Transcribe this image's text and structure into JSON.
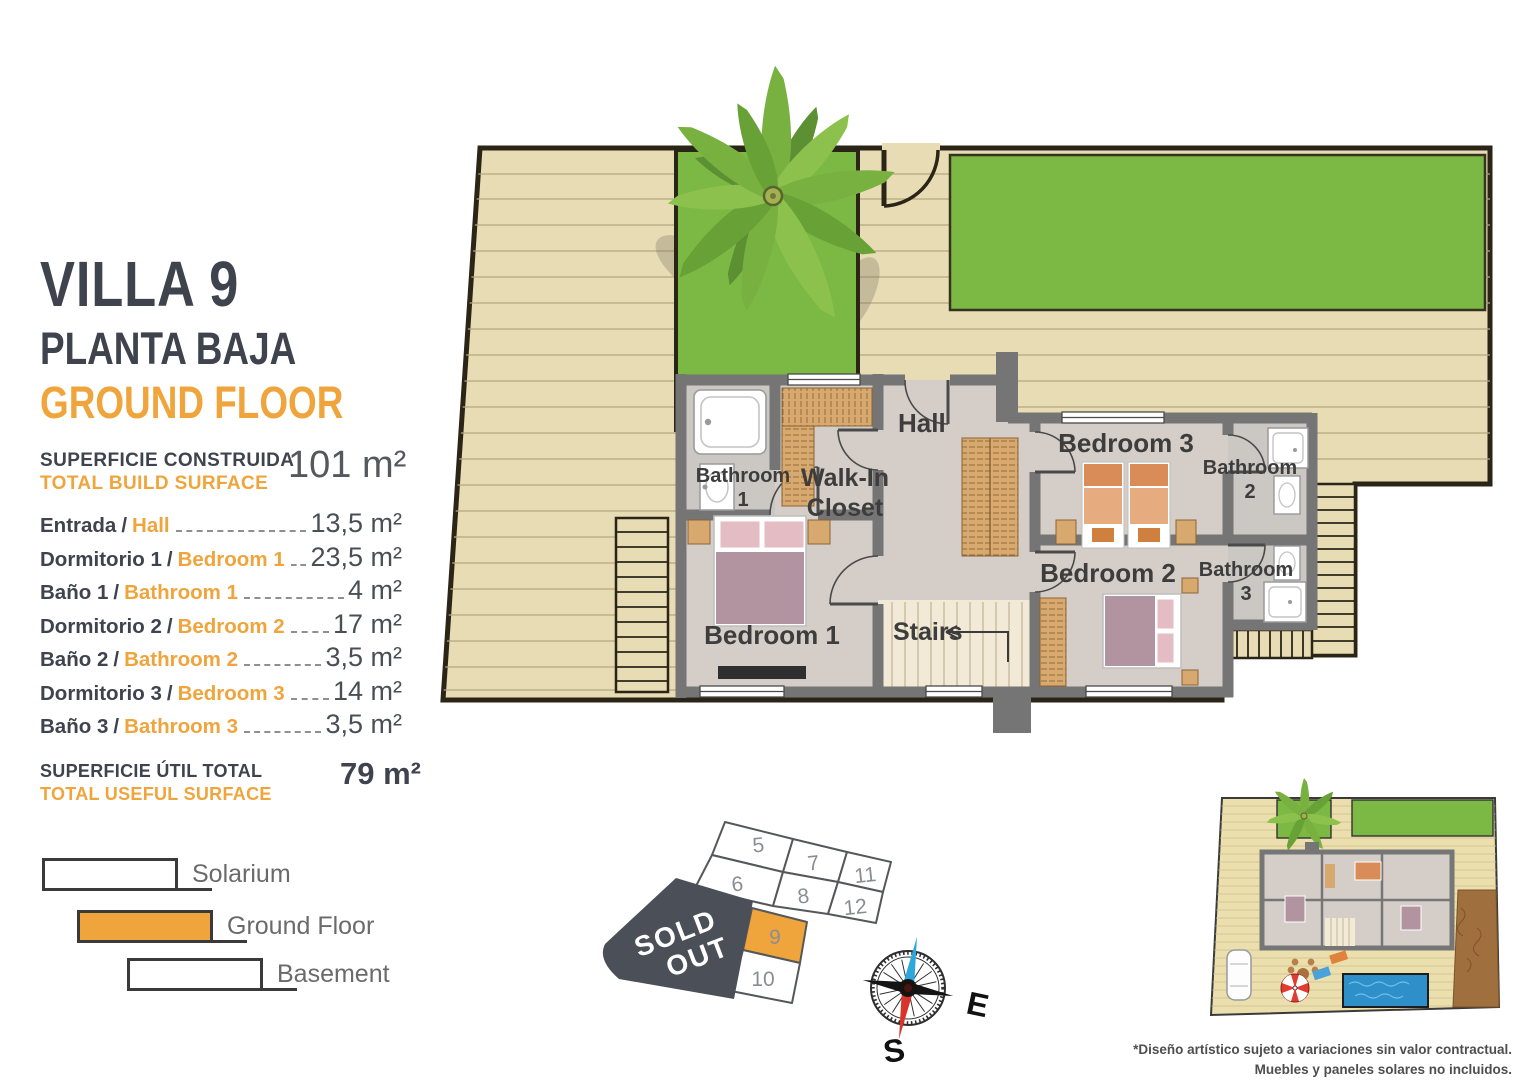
{
  "header": {
    "villa": "VILLA 9",
    "floor_es": "PLANTA BAJA",
    "floor_en": "GROUND FLOOR"
  },
  "build_surface": {
    "label_es": "SUPERFICIE CONSTRUIDA",
    "label_en": "TOTAL BUILD SURFACE",
    "value": "101 m²"
  },
  "ui": {
    "separator": "/"
  },
  "rooms": [
    {
      "es": "Entrada",
      "en": "Hall",
      "area": "13,5 m²"
    },
    {
      "es": "Dormitorio 1",
      "en": "Bedroom 1",
      "area": "23,5 m²"
    },
    {
      "es": "Baño 1",
      "en": "Bathroom 1",
      "area": "4 m²"
    },
    {
      "es": "Dormitorio 2",
      "en": "Bedroom 2",
      "area": "17 m²"
    },
    {
      "es": "Baño 2",
      "en": "Bathroom 2",
      "area": "3,5 m²"
    },
    {
      "es": "Dormitorio 3",
      "en": "Bedroom 3",
      "area": "14 m²"
    },
    {
      "es": "Baño 3",
      "en": "Bathroom 3",
      "area": "3,5 m²"
    }
  ],
  "useful_surface": {
    "label_es": "SUPERFICIE ÚTIL TOTAL",
    "label_en": "TOTAL USEFUL SURFACE",
    "value": "79 m²"
  },
  "legend": [
    {
      "label": "Solarium"
    },
    {
      "label": "Ground Floor"
    },
    {
      "label": "Basement"
    }
  ],
  "floorplan": {
    "hall": "Hall",
    "walkin_1": "Walk-In",
    "walkin_2": "Closet",
    "bedroom1": "Bedroom 1",
    "bedroom2": "Bedroom 2",
    "bedroom3": "Bedroom 3",
    "bathroom_word": "Bathroom",
    "bath1_num": "1",
    "bath2_num": "2",
    "bath3_num": "3",
    "stairs": "Stairs"
  },
  "plot_map": {
    "sold_1": "SOLD",
    "sold_2": "OUT",
    "plots": [
      "5",
      "6",
      "7",
      "8",
      "9",
      "10",
      "11",
      "12"
    ],
    "highlighted_plot": "9"
  },
  "compass": {
    "east": "E",
    "south": "S"
  },
  "disclaimer": {
    "line1": "*Diseño artístico sujeto a variaciones sin valor contractual.",
    "line2": "Muebles y paneles solares no incluidos."
  },
  "colors": {
    "accent_orange": "#F0A43C",
    "title_dark": "#3F434E",
    "lawn_green": "#7CB944",
    "deck_tan": "#E8DCB4",
    "wall_gray": "#757575",
    "sold_out_gray": "#4A4F58",
    "pool_blue": "#2F8FC9",
    "compass_north_blue": "#2DA8DD",
    "compass_south_red": "#D9342B",
    "bed_pink": "#B294A0",
    "bed_orange": "#D98C57",
    "wardrobe_tan": "#D8A96E"
  }
}
